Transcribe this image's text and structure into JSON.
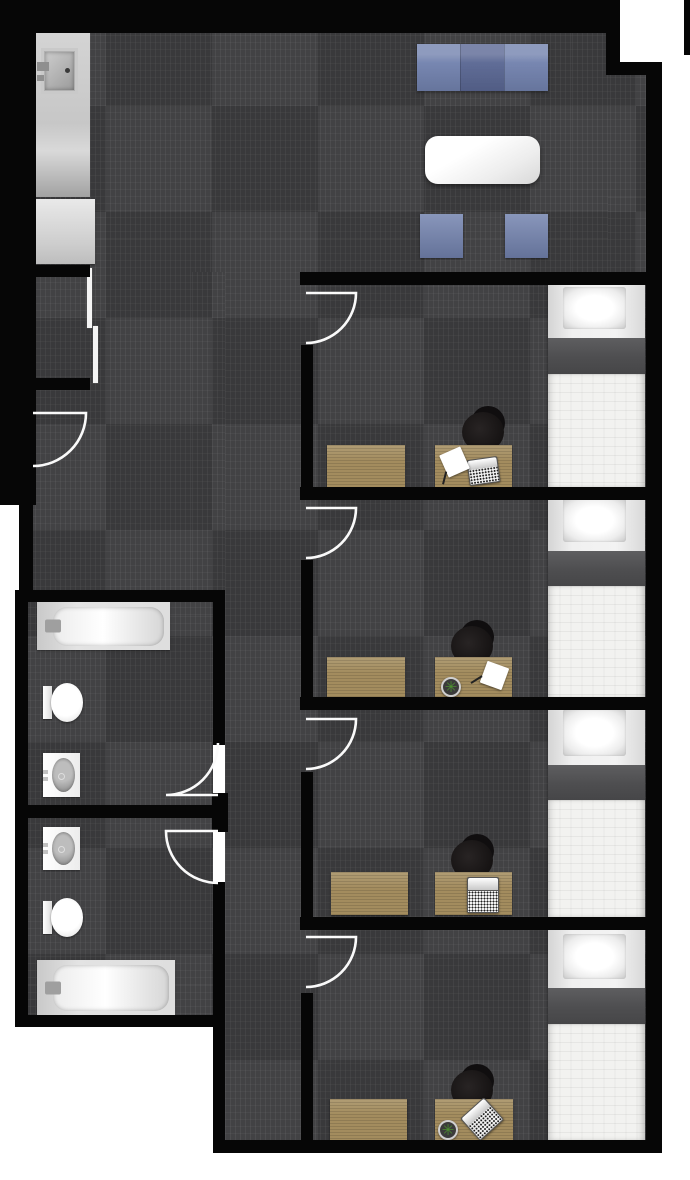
{
  "canvas": {
    "w": 690,
    "h": 1180,
    "bg": "#ffffff"
  },
  "palette": {
    "wall": "#060606",
    "carpet_base": "#424244",
    "door_line": "#fafafa",
    "sofa_blue": "#7282ae",
    "sofa_blue_dark": "#5a6793",
    "wood_tan": "#a38c5e",
    "bed_band_gray": "#4e4e50",
    "mattress_white": "#f2f2f0",
    "plant_green": "#4c8f31"
  },
  "glyphs": {
    "plant": "✳"
  },
  "carpet": {
    "tile_px": 106,
    "rects": [
      [
        36,
        33,
        572,
        239
      ],
      [
        608,
        75,
        40,
        197
      ],
      [
        225,
        272,
        423,
        868
      ],
      [
        33,
        272,
        192,
        318
      ],
      [
        28,
        602,
        185,
        205
      ],
      [
        28,
        818,
        185,
        197
      ]
    ]
  },
  "decor": {
    "wall_highlight": [
      35,
      20,
      580,
      2
    ]
  },
  "walls": [
    {
      "id": "top",
      "r": [
        0,
        0,
        620,
        33
      ]
    },
    {
      "id": "left-band",
      "r": [
        0,
        0,
        36,
        505
      ]
    },
    {
      "id": "left-lower",
      "r": [
        19,
        505,
        14,
        97
      ]
    },
    {
      "id": "notch-vertical",
      "r": [
        606,
        0,
        14,
        75
      ]
    },
    {
      "id": "notch-horizontal",
      "r": [
        606,
        62,
        56,
        13
      ]
    },
    {
      "id": "right",
      "r": [
        646,
        62,
        16,
        1091
      ]
    },
    {
      "id": "right-top-bar",
      "r": [
        684,
        0,
        6,
        55
      ]
    },
    {
      "id": "bottom",
      "r": [
        213,
        1140,
        449,
        13
      ]
    },
    {
      "id": "closet-top",
      "r": [
        35,
        265,
        55,
        12
      ]
    },
    {
      "id": "closet-bottom",
      "r": [
        35,
        378,
        55,
        12
      ]
    },
    {
      "id": "bath-top",
      "r": [
        15,
        590,
        210,
        12
      ]
    },
    {
      "id": "bath-left",
      "r": [
        15,
        590,
        13,
        437
      ]
    },
    {
      "id": "bath-mid",
      "r": [
        15,
        805,
        198,
        13
      ]
    },
    {
      "id": "bath-bottom",
      "r": [
        15,
        1015,
        210,
        12
      ]
    },
    {
      "id": "bath-right-upper",
      "r": [
        213,
        602,
        12,
        143
      ]
    },
    {
      "id": "bath-right-hinge",
      "r": [
        212,
        793,
        16,
        39
      ]
    },
    {
      "id": "bath-right-lower",
      "r": [
        213,
        882,
        12,
        271
      ]
    },
    {
      "id": "bed-divider-1",
      "r": [
        300,
        272,
        352,
        13
      ]
    },
    {
      "id": "bed-divider-2",
      "r": [
        300,
        487,
        352,
        13
      ]
    },
    {
      "id": "bed-divider-3",
      "r": [
        300,
        697,
        352,
        13
      ]
    },
    {
      "id": "bed-divider-4",
      "r": [
        300,
        917,
        352,
        13
      ]
    },
    {
      "id": "bedroom1-left",
      "r": [
        301,
        345,
        12,
        155
      ]
    },
    {
      "id": "bedroom2-left",
      "r": [
        301,
        560,
        12,
        150
      ]
    },
    {
      "id": "bedroom3-left",
      "r": [
        301,
        772,
        12,
        158
      ]
    },
    {
      "id": "bedroom4-left",
      "r": [
        301,
        993,
        12,
        160
      ]
    }
  ],
  "doors": [
    {
      "id": "entry-door",
      "path": "M33 413 L86 413 A53 53 0 0 1 33 466"
    },
    {
      "id": "bedroom1-door",
      "path": "M306 293 L356 293 A50 50 0 0 1 306 343"
    },
    {
      "id": "bedroom2-door",
      "path": "M306 508 L356 508 A50 50 0 0 1 306 558"
    },
    {
      "id": "bedroom3-door",
      "path": "M306 719 L356 719 A50 50 0 0 1 306 769"
    },
    {
      "id": "bedroom4-door",
      "path": "M306 937 L356 937 A50 50 0 0 1 306 987"
    },
    {
      "id": "bathroom1-door",
      "path": "M218 795 L166 795 A52 52 0 0 0 218 743"
    },
    {
      "id": "bathroom2-door",
      "path": "M218 831 L166 831 A52 52 0 0 0 218 883"
    }
  ],
  "furniture": [
    {
      "type": "couch",
      "name": "sofa",
      "room": "living-area",
      "x": 417,
      "y": 44,
      "w": 131,
      "h": 47
    },
    {
      "type": "table",
      "name": "coffee-table",
      "room": "living-area",
      "x": 425,
      "y": 136,
      "w": 115,
      "h": 48
    },
    {
      "type": "cube",
      "name": "lounge-chair-left",
      "room": "living-area",
      "x": 420,
      "y": 214,
      "w": 43,
      "h": 44
    },
    {
      "type": "cube",
      "name": "lounge-chair-right",
      "room": "living-area",
      "x": 505,
      "y": 214,
      "w": 43,
      "h": 44
    },
    {
      "type": "counter_sink",
      "name": "sink-counter",
      "room": "kitchenette",
      "x": 36,
      "y": 33,
      "w": 54,
      "h": 164
    },
    {
      "type": "counter",
      "name": "counter",
      "room": "kitchenette",
      "x": 36,
      "y": 199,
      "w": 59,
      "h": 65
    },
    {
      "type": "slider",
      "name": "closet-slider-door-upper",
      "room": "closet",
      "x": 87,
      "y": 268,
      "w": 5,
      "h": 60
    },
    {
      "type": "slider",
      "name": "closet-slider-door-lower",
      "room": "closet",
      "x": 93,
      "y": 326,
      "w": 5,
      "h": 57
    },
    {
      "type": "tub",
      "name": "bathtub",
      "room": "bathroom-1",
      "x": 37,
      "y": 602,
      "w": 133,
      "h": 48
    },
    {
      "type": "toilet",
      "name": "toilet",
      "room": "bathroom-1",
      "x": 43,
      "y": 683,
      "w": 40,
      "h": 39
    },
    {
      "type": "vanity",
      "name": "sink-vanity",
      "room": "bathroom-1",
      "x": 43,
      "y": 753,
      "w": 37,
      "h": 44
    },
    {
      "type": "vanity",
      "name": "sink-vanity",
      "room": "bathroom-2",
      "x": 43,
      "y": 827,
      "w": 37,
      "h": 43
    },
    {
      "type": "toilet",
      "name": "toilet",
      "room": "bathroom-2",
      "x": 43,
      "y": 898,
      "w": 40,
      "h": 39
    },
    {
      "type": "tub",
      "name": "bathtub",
      "room": "bathroom-2",
      "x": 37,
      "y": 960,
      "w": 138,
      "h": 55
    },
    {
      "type": "bed",
      "name": "bed",
      "room": "bedroom-1",
      "x": 548,
      "y": 281,
      "w": 97,
      "h": 206,
      "pillow_h": 57,
      "band_h": 36
    },
    {
      "type": "wood",
      "name": "dresser",
      "room": "bedroom-1",
      "x": 327,
      "y": 445,
      "w": 78,
      "h": 42
    },
    {
      "type": "chair",
      "name": "desk-chair",
      "room": "bedroom-1",
      "cx": 483,
      "cy": 430
    },
    {
      "type": "wood",
      "name": "desk",
      "room": "bedroom-1",
      "x": 435,
      "y": 445,
      "w": 77,
      "h": 42
    },
    {
      "type": "laptop",
      "name": "laptop",
      "room": "bedroom-1",
      "x": 468,
      "y": 458,
      "w": 31,
      "h": 26,
      "rot": -8
    },
    {
      "type": "paper",
      "name": "paper-with-pen",
      "room": "bedroom-1",
      "x": 443,
      "y": 450,
      "w": 23,
      "h": 24,
      "rot": -24
    },
    {
      "type": "bed",
      "name": "bed",
      "room": "bedroom-2",
      "x": 548,
      "y": 492,
      "w": 97,
      "h": 206,
      "pillow_h": 59,
      "band_h": 35
    },
    {
      "type": "wood",
      "name": "dresser",
      "room": "bedroom-2",
      "x": 327,
      "y": 657,
      "w": 78,
      "h": 41
    },
    {
      "type": "chair",
      "name": "desk-chair",
      "room": "bedroom-2",
      "cx": 472,
      "cy": 644
    },
    {
      "type": "wood",
      "name": "desk",
      "room": "bedroom-2",
      "x": 435,
      "y": 657,
      "w": 77,
      "h": 41
    },
    {
      "type": "plant",
      "name": "potted-plant",
      "room": "bedroom-2",
      "cx": 451,
      "cy": 687,
      "r": 10
    },
    {
      "type": "paper",
      "name": "paper-with-pen",
      "room": "bedroom-2",
      "x": 483,
      "y": 664,
      "w": 23,
      "h": 23,
      "rot": 20
    },
    {
      "type": "bed",
      "name": "bed",
      "room": "bedroom-3",
      "x": 548,
      "y": 703,
      "w": 97,
      "h": 214,
      "pillow_h": 62,
      "band_h": 35
    },
    {
      "type": "wood",
      "name": "dresser",
      "room": "bedroom-3",
      "x": 331,
      "y": 872,
      "w": 77,
      "h": 43
    },
    {
      "type": "chair",
      "name": "desk-chair",
      "room": "bedroom-3",
      "cx": 472,
      "cy": 858
    },
    {
      "type": "wood",
      "name": "desk",
      "room": "bedroom-3",
      "x": 435,
      "y": 872,
      "w": 77,
      "h": 43
    },
    {
      "type": "laptop",
      "name": "laptop",
      "room": "bedroom-3",
      "x": 467,
      "y": 877,
      "w": 32,
      "h": 36,
      "rot": 0
    },
    {
      "type": "bed",
      "name": "bed",
      "room": "bedroom-4",
      "x": 548,
      "y": 928,
      "w": 97,
      "h": 212,
      "pillow_h": 60,
      "band_h": 36
    },
    {
      "type": "wood",
      "name": "dresser",
      "room": "bedroom-4",
      "x": 330,
      "y": 1099,
      "w": 77,
      "h": 41
    },
    {
      "type": "chair",
      "name": "desk-chair",
      "room": "bedroom-4",
      "cx": 472,
      "cy": 1088
    },
    {
      "type": "wood",
      "name": "desk",
      "room": "bedroom-4",
      "x": 435,
      "y": 1099,
      "w": 78,
      "h": 41
    },
    {
      "type": "plant",
      "name": "potted-plant",
      "room": "bedroom-4",
      "cx": 448,
      "cy": 1130,
      "r": 10
    },
    {
      "type": "laptop",
      "name": "laptop",
      "room": "bedroom-4",
      "x": 466,
      "y": 1104,
      "w": 32,
      "h": 30,
      "rot": -42
    }
  ]
}
